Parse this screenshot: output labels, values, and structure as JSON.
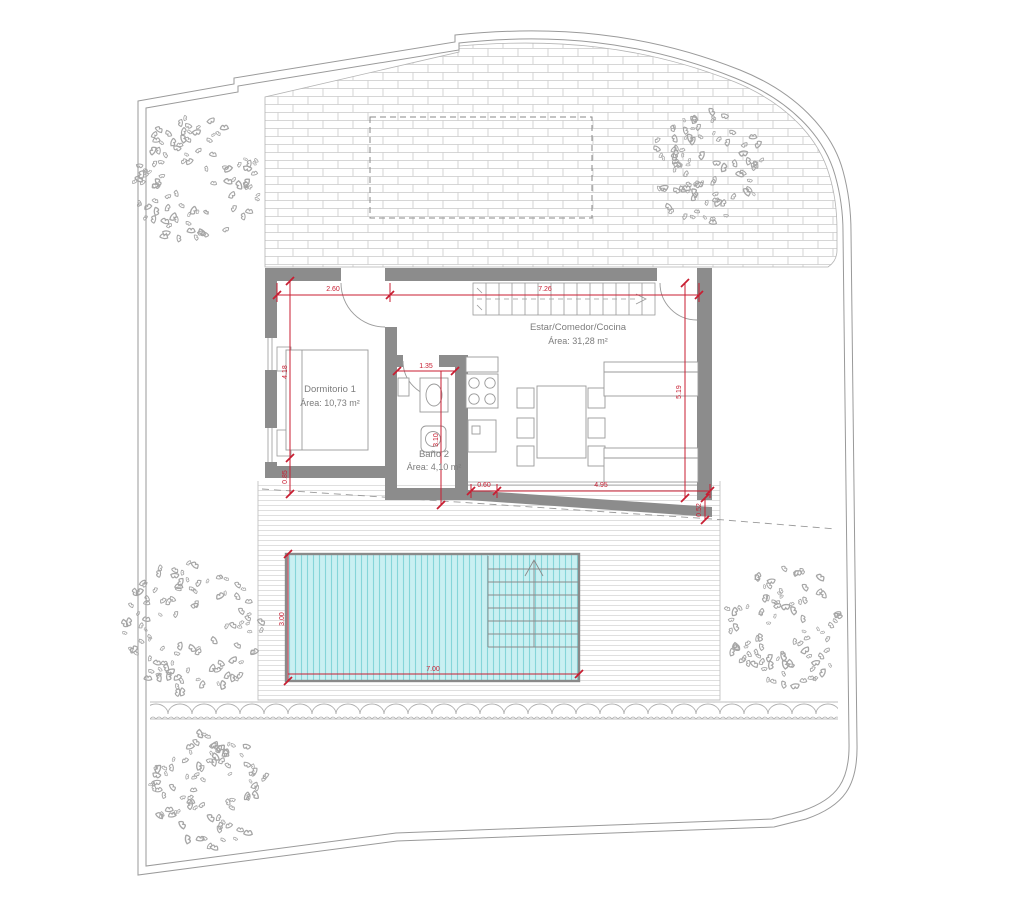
{
  "drawing": {
    "type": "architectural-floor-plan"
  },
  "colors": {
    "dimension_red": "#c81e32",
    "wall_gray": "#8c8c8c",
    "line_gray": "#9a9a9a",
    "pool_fill": "#c9f0f2",
    "pool_stripe": "#85d5d9"
  },
  "rooms": {
    "living": {
      "name": "Estar/Comedor/Cocina",
      "area": "Área: 31,28 m²"
    },
    "bedroom": {
      "name": "Dormitorio 1",
      "area": "Área: 10,73 m²"
    },
    "bathroom": {
      "name": "Baño 2",
      "area": "Área: 4,10 m²"
    }
  },
  "dimensions": {
    "bedroom_width": "2.60",
    "living_width": "7.26",
    "bedroom_depth": "4.18",
    "left_offset": "0.85",
    "bathroom_width": "1.35",
    "bathroom_depth": "3.10",
    "terrace_offset": "0.60",
    "living_glass_width": "4.95",
    "right_depth": "5.19",
    "right_offset": "0.52",
    "pool_length": "7.00",
    "pool_width": "3.00"
  }
}
